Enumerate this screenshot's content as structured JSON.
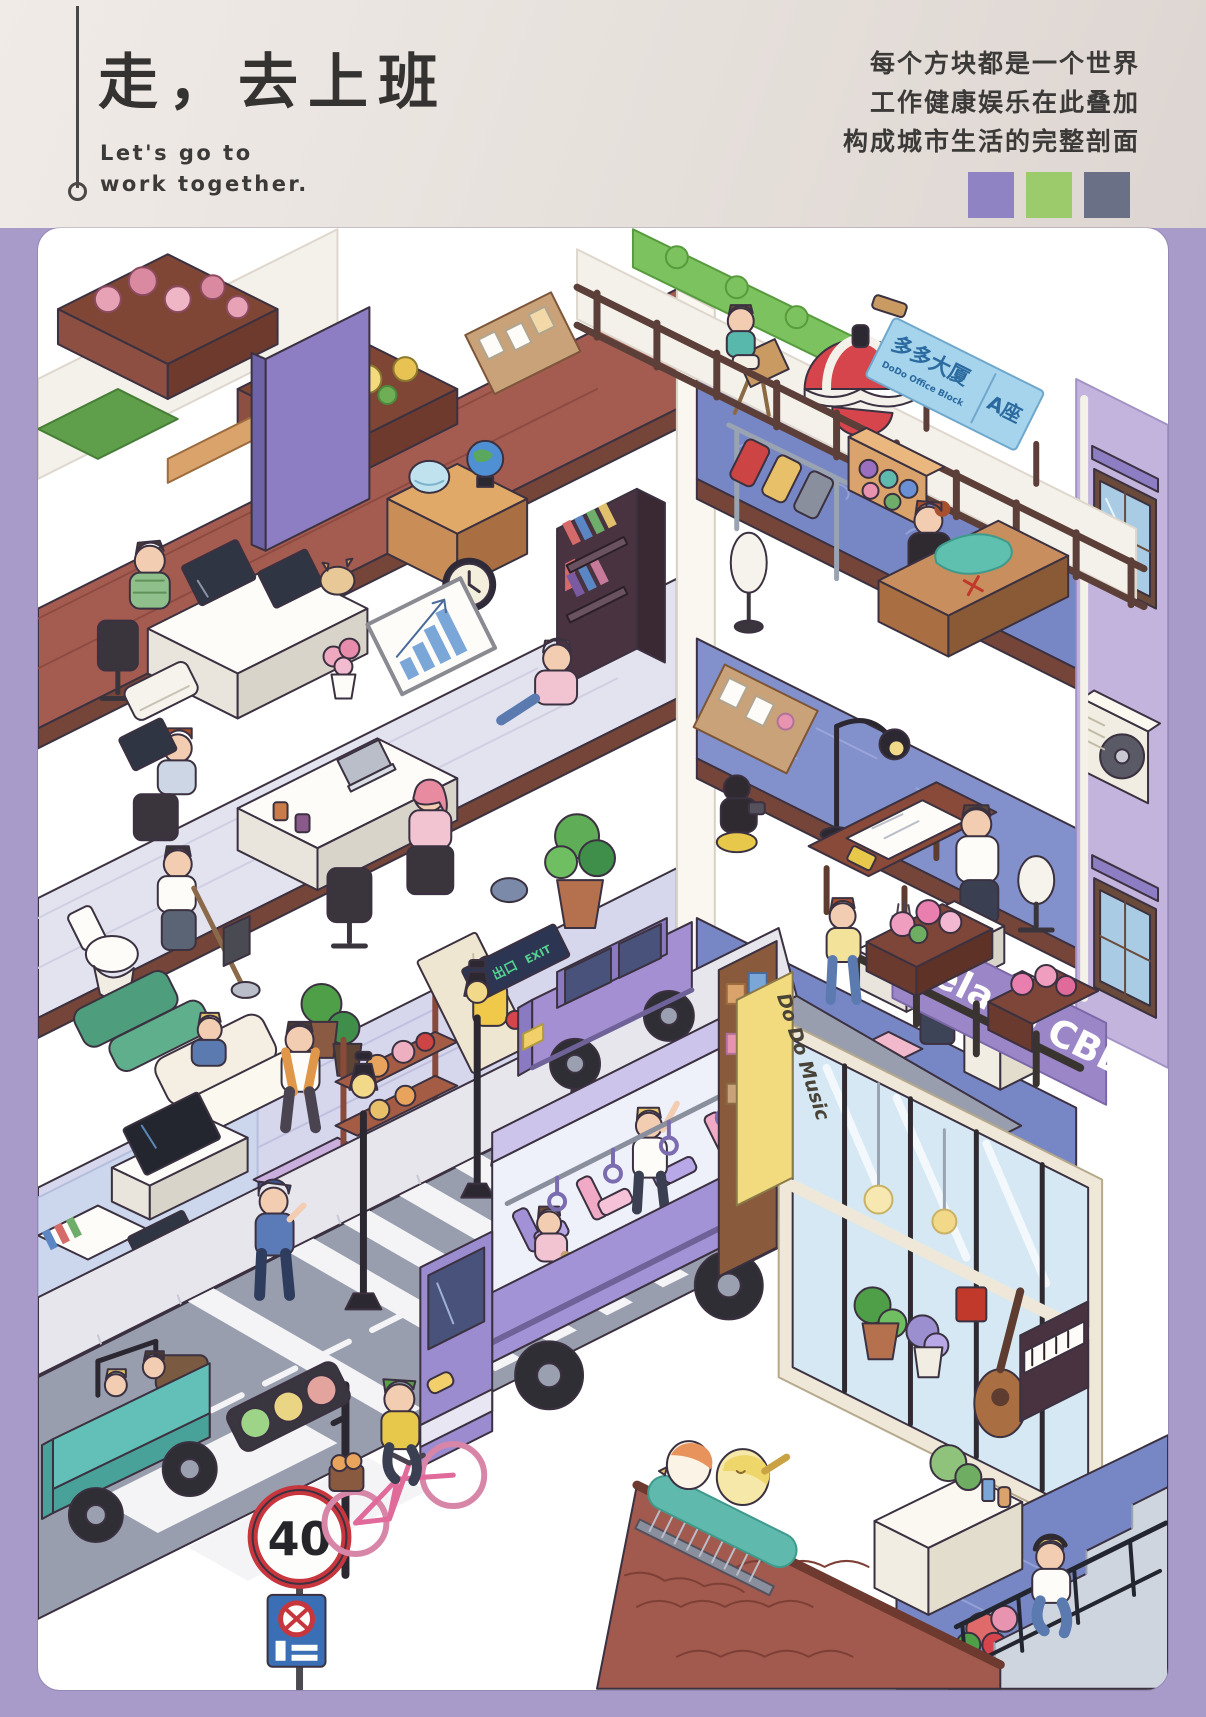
{
  "page": {
    "background_hex": "#a89bca",
    "canvas_hex": "#ffffff"
  },
  "header": {
    "title": "走，去上班",
    "subtitle_lines": [
      "Let's go to",
      "work together."
    ],
    "tagline_lines": [
      "每个方块都是一个世界",
      "工作健康娱乐在此叠加",
      "构成城市生活的完整剖面"
    ],
    "palette": [
      {
        "name": "purple",
        "hex": "#9083c3"
      },
      {
        "name": "green",
        "hex": "#9ccb6b"
      },
      {
        "name": "slate-gray",
        "hex": "#6a7187"
      }
    ]
  },
  "illustration": {
    "signs": {
      "rooftop_board_cn": "多多大厦",
      "rooftop_board_en": "DoDo Office Block",
      "rooftop_board_block": "A座",
      "cbd_sign": "Telado CBD",
      "music_shop_sign": "Do Do Music",
      "speed_limit": "40",
      "exit_arrow": "←",
      "exit_cn": "出口",
      "exit_en": "EXIT"
    },
    "key_colors": {
      "bus_purple": "#a293d6",
      "road_gray": "#989eae",
      "roof_tile_red": "#a2594e",
      "floor_tile_blue": "#7787c5",
      "umbrella_red": "#d6444c",
      "jeep_teal": "#62c0b8",
      "rooftop_sign_blue": "#a6d4ec",
      "exit_green": "#54d28e",
      "brick_floor": "#a55c50",
      "slab_brown": "#744538"
    }
  }
}
